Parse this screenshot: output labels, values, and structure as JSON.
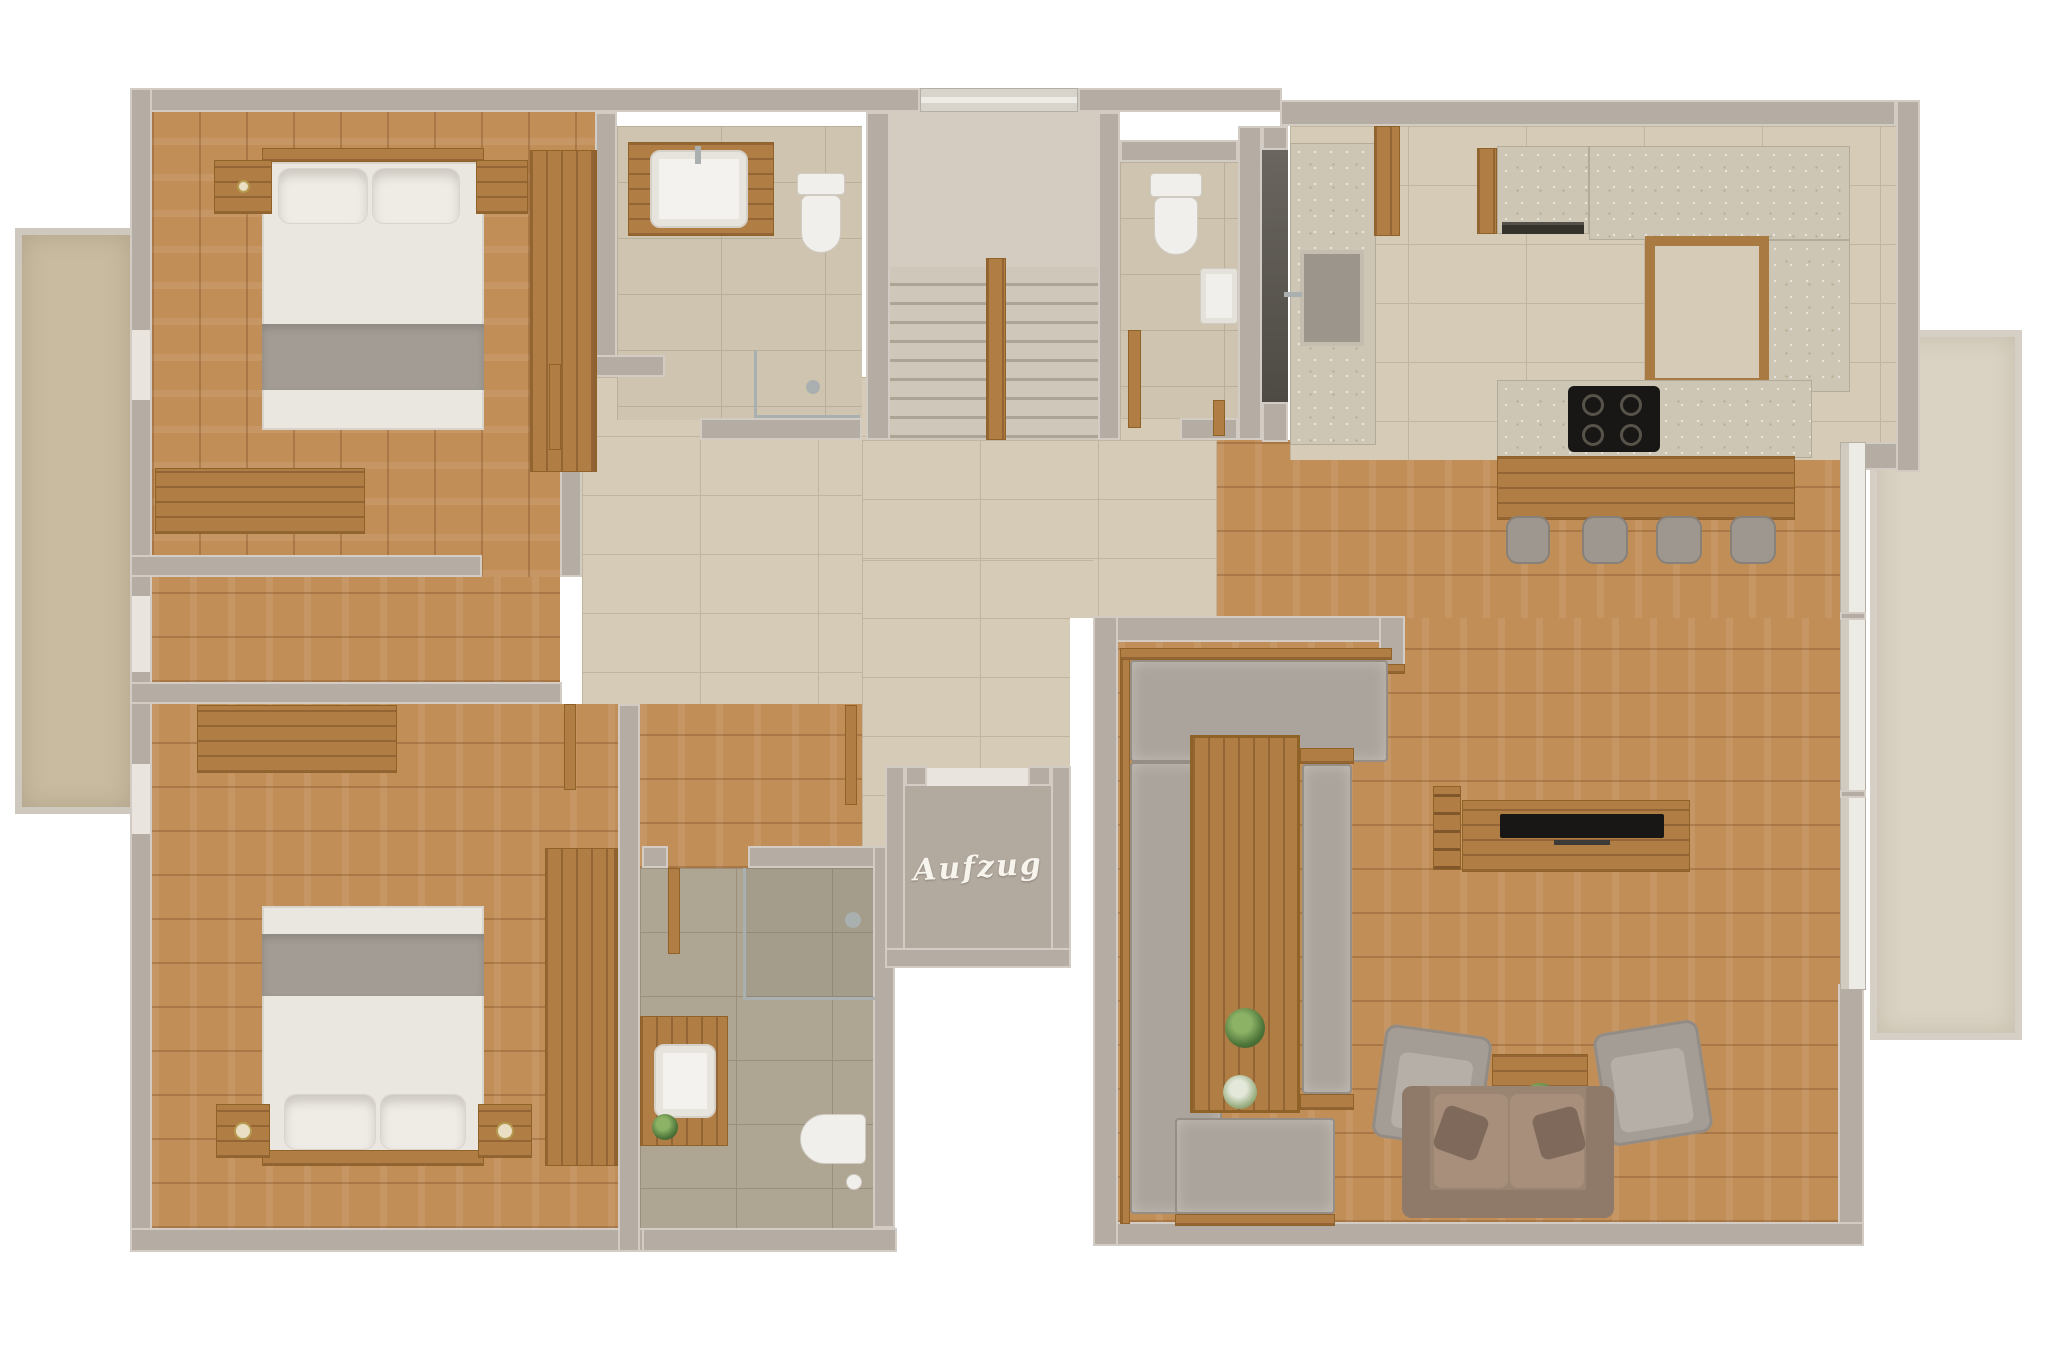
{
  "plan": {
    "elevator_label": "Aufzug",
    "colors": {
      "wall": "#b5aca3",
      "wallEdge": "#d2ccc4",
      "hallTile": "#d6cbb7",
      "hallTileLine": "#c2b59e",
      "bath1Tile": "#cec4b0",
      "bath1TileLine": "#bab09a",
      "bath2Tile": "#aea693",
      "bath2TileLine": "#998f7c",
      "woodFloor": "#c28e58",
      "furnWood": "#b07d45",
      "stone": "#cdc6b5",
      "benchGray": "#aba49c",
      "chairGray": "#a49d96",
      "sofaBrown": "#9a8472",
      "linen": "#eae7e0",
      "blanket": "#a29c94",
      "plantGreen": "#4c7338",
      "stairTread": "#cfc7ba",
      "stairLine": "#ada496",
      "elevatorFloor": "#b2a99f",
      "labelWhite": "#f7f4ee",
      "windowFrame": "#edebe6",
      "tvBlack": "#181715",
      "sandLeft": "#c8bba0",
      "sandRight": "#dad2c2"
    }
  }
}
